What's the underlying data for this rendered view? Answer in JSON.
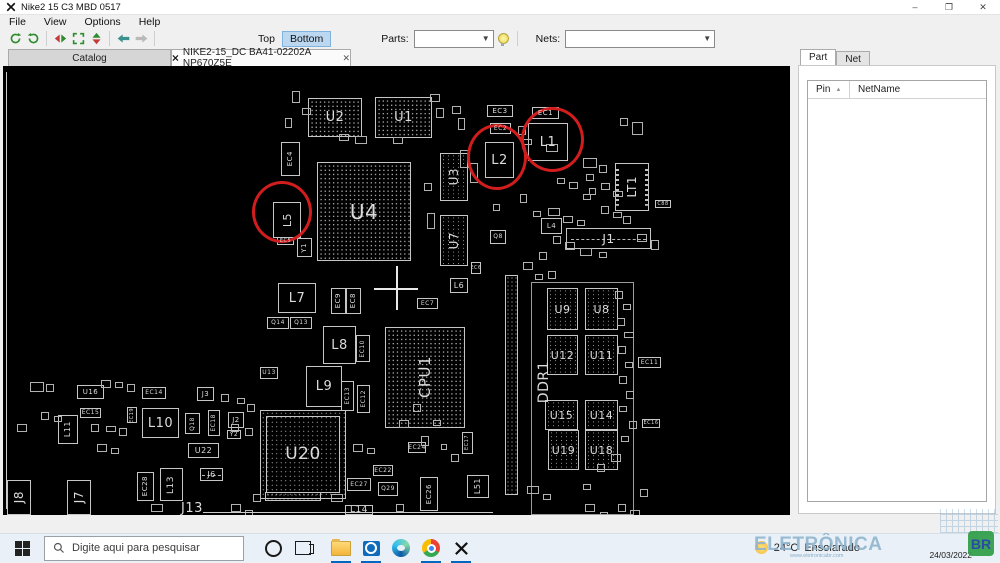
{
  "window": {
    "title": "Nike2 15 C3 MBD 0517",
    "controls": {
      "minimize": "–",
      "maximize": "❐",
      "close": "✕"
    }
  },
  "menu": {
    "items": [
      "File",
      "View",
      "Options",
      "Help"
    ]
  },
  "toolbar": {
    "top_label": "Top",
    "bottom_label": "Bottom",
    "parts_label": "Parts:",
    "parts_value": "",
    "nets_label": "Nets:",
    "nets_value": ""
  },
  "tabs": [
    {
      "label": "Catalog",
      "active": false
    },
    {
      "label": "NIKE2-15_DC BA41-02202A NP670Z5E",
      "active": true,
      "close_glyph": "✕"
    }
  ],
  "side_panel": {
    "tabs": [
      {
        "label": "Part",
        "active": true
      },
      {
        "label": "Net",
        "active": false
      }
    ],
    "table": {
      "columns": [
        "Pin",
        "NetName"
      ],
      "sort_indicator": "▲",
      "rows": []
    }
  },
  "board": {
    "components": [
      {
        "l": "U2",
        "x": 305,
        "y": 32,
        "w": 54,
        "h": 39,
        "t": "bga",
        "fs": 13
      },
      {
        "l": "U1",
        "x": 372,
        "y": 31,
        "w": 57,
        "h": 41,
        "t": "bga",
        "fs": 13
      },
      {
        "l": "EC3",
        "x": 484,
        "y": 39,
        "w": 26,
        "h": 12,
        "fs": 7
      },
      {
        "l": "EC1",
        "x": 529,
        "y": 41,
        "w": 27,
        "h": 12,
        "fs": 7
      },
      {
        "l": "EC2",
        "x": 487,
        "y": 57,
        "w": 21,
        "h": 11,
        "fs": 6
      },
      {
        "l": "L2",
        "x": 482,
        "y": 76,
        "w": 29,
        "h": 36,
        "fs": 13
      },
      {
        "l": "L1",
        "x": 525,
        "y": 57,
        "w": 40,
        "h": 38,
        "fs": 13
      },
      {
        "l": "U3",
        "x": 437,
        "y": 87,
        "w": 28,
        "h": 48,
        "t": "mem",
        "v": 1,
        "fs": 12
      },
      {
        "l": "EC4",
        "x": 278,
        "y": 76,
        "w": 19,
        "h": 34,
        "v": 1,
        "fs": 7
      },
      {
        "l": "L5",
        "x": 270,
        "y": 136,
        "w": 28,
        "h": 36,
        "v": 1,
        "fs": 11
      },
      {
        "l": "EC5",
        "x": 274,
        "y": 171,
        "w": 17,
        "h": 8,
        "fs": 5
      },
      {
        "l": "Y1",
        "x": 294,
        "y": 172,
        "w": 15,
        "h": 19,
        "v": 1,
        "fs": 7
      },
      {
        "l": "U4",
        "x": 314,
        "y": 96,
        "w": 94,
        "h": 99,
        "t": "bga",
        "fs": 20
      },
      {
        "l": "U7",
        "x": 437,
        "y": 149,
        "w": 28,
        "h": 51,
        "t": "mem",
        "v": 1,
        "fs": 12
      },
      {
        "l": "EC6",
        "x": 468,
        "y": 196,
        "w": 10,
        "h": 12,
        "fs": 5
      },
      {
        "l": "L7",
        "x": 275,
        "y": 217,
        "w": 38,
        "h": 30,
        "fs": 13
      },
      {
        "l": "Q14",
        "x": 264,
        "y": 251,
        "w": 22,
        "h": 12,
        "fs": 6
      },
      {
        "l": "Q13",
        "x": 287,
        "y": 251,
        "w": 22,
        "h": 12,
        "fs": 6
      },
      {
        "l": "EC9",
        "x": 328,
        "y": 222,
        "w": 15,
        "h": 26,
        "v": 1,
        "fs": 7
      },
      {
        "l": "EC8",
        "x": 343,
        "y": 222,
        "w": 15,
        "h": 26,
        "v": 1,
        "fs": 7
      },
      {
        "l": "L8",
        "x": 320,
        "y": 260,
        "w": 33,
        "h": 38,
        "fs": 13
      },
      {
        "l": "EC10",
        "x": 353,
        "y": 269,
        "w": 14,
        "h": 27,
        "v": 1,
        "fs": 6
      },
      {
        "l": "L9",
        "x": 303,
        "y": 300,
        "w": 36,
        "h": 41,
        "fs": 13
      },
      {
        "l": "EC13",
        "x": 338,
        "y": 315,
        "w": 13,
        "h": 30,
        "v": 1,
        "fs": 6
      },
      {
        "l": "EC12",
        "x": 354,
        "y": 319,
        "w": 13,
        "h": 28,
        "v": 1,
        "fs": 6
      },
      {
        "l": "U13",
        "x": 257,
        "y": 301,
        "w": 18,
        "h": 12,
        "fs": 6
      },
      {
        "l": "CPU1",
        "x": 382,
        "y": 261,
        "w": 80,
        "h": 101,
        "t": "bga",
        "v": 1,
        "fs": 15
      },
      {
        "l": "L6",
        "x": 447,
        "y": 212,
        "w": 18,
        "h": 15,
        "fs": 8
      },
      {
        "l": "EC7",
        "x": 414,
        "y": 232,
        "w": 21,
        "h": 11,
        "fs": 6
      },
      {
        "l": "Q8",
        "x": 487,
        "y": 164,
        "w": 16,
        "h": 14,
        "fs": 6
      },
      {
        "l": "L4",
        "x": 538,
        "y": 152,
        "w": 21,
        "h": 16,
        "fs": 7
      },
      {
        "l": "J1",
        "x": 563,
        "y": 162,
        "w": 85,
        "h": 21,
        "t": "conn",
        "fs": 12
      },
      {
        "l": "LT1",
        "x": 612,
        "y": 97,
        "w": 34,
        "h": 48,
        "t": "conn2",
        "v": 1,
        "fs": 12
      },
      {
        "l": "C88",
        "x": 652,
        "y": 134,
        "w": 16,
        "h": 8,
        "fs": 5
      },
      {
        "l": "DDR1",
        "x": 534,
        "y": 284,
        "w": 14,
        "h": 64,
        "t": "noborder",
        "v": 1,
        "fs": 14
      },
      {
        "l": "U9",
        "x": 544,
        "y": 222,
        "w": 31,
        "h": 42,
        "t": "mem",
        "fs": 11
      },
      {
        "l": "U8",
        "x": 582,
        "y": 222,
        "w": 33,
        "h": 42,
        "t": "mem",
        "fs": 11
      },
      {
        "l": "U12",
        "x": 544,
        "y": 269,
        "w": 31,
        "h": 40,
        "t": "mem",
        "fs": 11
      },
      {
        "l": "U11",
        "x": 582,
        "y": 269,
        "w": 33,
        "h": 40,
        "t": "mem",
        "fs": 11
      },
      {
        "l": "U15",
        "x": 542,
        "y": 334,
        "w": 33,
        "h": 30,
        "t": "mem",
        "fs": 11
      },
      {
        "l": "U14",
        "x": 582,
        "y": 334,
        "w": 33,
        "h": 30,
        "t": "mem",
        "fs": 11
      },
      {
        "l": "U19",
        "x": 545,
        "y": 364,
        "w": 31,
        "h": 40,
        "t": "mem",
        "fs": 11
      },
      {
        "l": "U18",
        "x": 582,
        "y": 364,
        "w": 33,
        "h": 40,
        "t": "mem",
        "fs": 11
      },
      {
        "l": "EC11",
        "x": 635,
        "y": 291,
        "w": 23,
        "h": 11,
        "fs": 6
      },
      {
        "l": "EC16",
        "x": 639,
        "y": 353,
        "w": 18,
        "h": 9,
        "fs": 5
      },
      {
        "l": "U16",
        "x": 74,
        "y": 319,
        "w": 27,
        "h": 14,
        "fs": 7
      },
      {
        "l": "EC14",
        "x": 139,
        "y": 321,
        "w": 24,
        "h": 12,
        "fs": 6
      },
      {
        "l": "J3",
        "x": 194,
        "y": 321,
        "w": 17,
        "h": 14,
        "fs": 7
      },
      {
        "l": "EC15",
        "x": 77,
        "y": 342,
        "w": 21,
        "h": 10,
        "fs": 6
      },
      {
        "l": "L11",
        "x": 55,
        "y": 349,
        "w": 20,
        "h": 29,
        "v": 1,
        "fs": 8
      },
      {
        "l": "L10",
        "x": 139,
        "y": 342,
        "w": 37,
        "h": 30,
        "fs": 13
      },
      {
        "l": "Q18",
        "x": 182,
        "y": 347,
        "w": 15,
        "h": 21,
        "v": 1,
        "fs": 6
      },
      {
        "l": "EC18",
        "x": 205,
        "y": 344,
        "w": 12,
        "h": 26,
        "v": 1,
        "fs": 6
      },
      {
        "l": "J2",
        "x": 225,
        "y": 346,
        "w": 16,
        "h": 16,
        "fs": 7
      },
      {
        "l": "Y2",
        "x": 224,
        "y": 364,
        "w": 14,
        "h": 9,
        "fs": 6
      },
      {
        "l": "U22",
        "x": 185,
        "y": 377,
        "w": 31,
        "h": 15,
        "fs": 8
      },
      {
        "l": "J6",
        "x": 197,
        "y": 402,
        "w": 23,
        "h": 13,
        "t": "conn",
        "fs": 8
      },
      {
        "l": "EC28",
        "x": 134,
        "y": 406,
        "w": 17,
        "h": 29,
        "v": 1,
        "fs": 7
      },
      {
        "l": "L13",
        "x": 157,
        "y": 402,
        "w": 23,
        "h": 33,
        "v": 1,
        "fs": 9
      },
      {
        "l": "J13",
        "x": 172,
        "y": 436,
        "w": 34,
        "h": 13,
        "t": "noborder",
        "fs": 13
      },
      {
        "l": "J8",
        "x": 4,
        "y": 414,
        "w": 24,
        "h": 35,
        "v": 1,
        "fs": 12
      },
      {
        "l": "J7",
        "x": 64,
        "y": 414,
        "w": 24,
        "h": 35,
        "v": 1,
        "fs": 12
      },
      {
        "l": "U20",
        "x": 257,
        "y": 344,
        "w": 86,
        "h": 89,
        "t": "qfp",
        "fs": 17
      },
      {
        "l": "EC24",
        "x": 405,
        "y": 376,
        "w": 18,
        "h": 11,
        "fs": 6
      },
      {
        "l": "EC22",
        "x": 370,
        "y": 399,
        "w": 20,
        "h": 11,
        "fs": 6
      },
      {
        "l": "EC27",
        "x": 344,
        "y": 412,
        "w": 24,
        "h": 13,
        "fs": 6
      },
      {
        "l": "Q29",
        "x": 375,
        "y": 416,
        "w": 20,
        "h": 14,
        "fs": 6
      },
      {
        "l": "EC26",
        "x": 417,
        "y": 411,
        "w": 18,
        "h": 34,
        "v": 1,
        "fs": 7
      },
      {
        "l": "L51",
        "x": 464,
        "y": 409,
        "w": 22,
        "h": 23,
        "v": 1,
        "fs": 8
      },
      {
        "l": "L14",
        "x": 342,
        "y": 439,
        "w": 28,
        "h": 10,
        "fs": 9
      },
      {
        "l": "EC17",
        "x": 459,
        "y": 366,
        "w": 11,
        "h": 22,
        "v": 1,
        "fs": 5
      },
      {
        "l": "EC19",
        "x": 124,
        "y": 341,
        "w": 10,
        "h": 16,
        "v": 1,
        "fs": 5
      },
      {
        "t": "outline",
        "x": 528,
        "y": 216,
        "w": 103,
        "h": 233
      },
      {
        "t": "dotcol",
        "x": 502,
        "y": 209,
        "w": 13,
        "h": 220
      },
      {
        "t": "dotrow",
        "x": 262,
        "y": 426,
        "w": 56,
        "h": 9
      }
    ],
    "small_parts": [
      [
        289,
        25,
        8,
        12
      ],
      [
        299,
        42,
        9,
        7
      ],
      [
        282,
        52,
        7,
        10
      ],
      [
        336,
        68,
        10,
        7
      ],
      [
        352,
        70,
        12,
        8
      ],
      [
        390,
        71,
        10,
        7
      ],
      [
        427,
        28,
        10,
        8
      ],
      [
        433,
        42,
        8,
        10
      ],
      [
        449,
        40,
        9,
        8
      ],
      [
        455,
        52,
        7,
        12
      ],
      [
        457,
        84,
        9,
        18
      ],
      [
        467,
        97,
        8,
        20
      ],
      [
        515,
        60,
        8,
        9
      ],
      [
        519,
        73,
        10,
        6
      ],
      [
        543,
        78,
        12,
        8
      ],
      [
        580,
        92,
        14,
        10
      ],
      [
        583,
        108,
        8,
        7
      ],
      [
        596,
        99,
        8,
        8
      ],
      [
        617,
        52,
        8,
        8
      ],
      [
        629,
        56,
        11,
        13
      ],
      [
        598,
        117,
        9,
        7
      ],
      [
        610,
        125,
        10,
        6
      ],
      [
        580,
        128,
        8,
        6
      ],
      [
        530,
        145,
        8,
        6
      ],
      [
        545,
        142,
        12,
        8
      ],
      [
        421,
        117,
        8,
        8
      ],
      [
        424,
        147,
        8,
        16
      ],
      [
        490,
        138,
        7,
        7
      ],
      [
        517,
        128,
        7,
        9
      ],
      [
        554,
        112,
        8,
        6
      ],
      [
        566,
        116,
        9,
        7
      ],
      [
        586,
        122,
        7,
        7
      ],
      [
        598,
        140,
        8,
        8
      ],
      [
        610,
        146,
        9,
        6
      ],
      [
        620,
        150,
        8,
        8
      ],
      [
        634,
        168,
        10,
        8
      ],
      [
        648,
        174,
        8,
        10
      ],
      [
        560,
        150,
        10,
        7
      ],
      [
        574,
        154,
        8,
        6
      ],
      [
        550,
        170,
        8,
        8
      ],
      [
        562,
        176,
        10,
        8
      ],
      [
        577,
        182,
        12,
        8
      ],
      [
        536,
        186,
        8,
        8
      ],
      [
        596,
        186,
        8,
        6
      ],
      [
        520,
        196,
        10,
        8
      ],
      [
        532,
        208,
        8,
        6
      ],
      [
        545,
        205,
        8,
        8
      ],
      [
        612,
        225,
        8,
        8
      ],
      [
        620,
        238,
        8,
        6
      ],
      [
        614,
        252,
        8,
        8
      ],
      [
        621,
        266,
        10,
        6
      ],
      [
        615,
        280,
        8,
        8
      ],
      [
        622,
        296,
        8,
        6
      ],
      [
        616,
        310,
        8,
        8
      ],
      [
        623,
        325,
        8,
        8
      ],
      [
        616,
        340,
        8,
        6
      ],
      [
        626,
        355,
        8,
        8
      ],
      [
        618,
        370,
        8,
        6
      ],
      [
        608,
        388,
        10,
        8
      ],
      [
        594,
        398,
        8,
        8
      ],
      [
        27,
        316,
        14,
        10
      ],
      [
        43,
        318,
        8,
        8
      ],
      [
        98,
        314,
        10,
        8
      ],
      [
        112,
        316,
        8,
        6
      ],
      [
        124,
        318,
        8,
        8
      ],
      [
        38,
        346,
        8,
        8
      ],
      [
        51,
        350,
        8,
        6
      ],
      [
        88,
        358,
        8,
        8
      ],
      [
        103,
        360,
        10,
        6
      ],
      [
        116,
        362,
        8,
        8
      ],
      [
        218,
        328,
        8,
        8
      ],
      [
        234,
        332,
        8,
        6
      ],
      [
        244,
        338,
        8,
        8
      ],
      [
        14,
        358,
        10,
        8
      ],
      [
        228,
        358,
        8,
        8
      ],
      [
        242,
        362,
        8,
        8
      ],
      [
        94,
        378,
        10,
        8
      ],
      [
        108,
        382,
        8,
        6
      ],
      [
        148,
        438,
        12,
        8
      ],
      [
        228,
        438,
        10,
        8
      ],
      [
        242,
        444,
        8,
        6
      ],
      [
        250,
        428,
        8,
        8
      ],
      [
        350,
        378,
        10,
        8
      ],
      [
        364,
        382,
        8,
        6
      ],
      [
        328,
        428,
        12,
        8
      ],
      [
        393,
        438,
        8,
        8
      ],
      [
        418,
        370,
        8,
        10
      ],
      [
        438,
        378,
        6,
        6
      ],
      [
        448,
        388,
        8,
        8
      ],
      [
        430,
        354,
        8,
        6
      ],
      [
        396,
        354,
        10,
        8
      ],
      [
        410,
        338,
        8,
        8
      ],
      [
        582,
        438,
        10,
        8
      ],
      [
        597,
        446,
        8,
        6
      ],
      [
        615,
        438,
        8,
        8
      ],
      [
        627,
        444,
        10,
        8
      ],
      [
        580,
        418,
        8,
        6
      ],
      [
        637,
        423,
        8,
        8
      ],
      [
        524,
        420,
        12,
        8
      ],
      [
        540,
        428,
        8,
        6
      ]
    ],
    "highlights": [
      {
        "x": 249,
        "y": 115,
        "w": 60,
        "h": 62
      },
      {
        "x": 464,
        "y": 58,
        "w": 60,
        "h": 66
      },
      {
        "x": 518,
        "y": 41,
        "w": 63,
        "h": 65
      }
    ],
    "lines": [
      {
        "x": 3,
        "y": 6,
        "w": 1,
        "h": 437
      },
      {
        "x": 200,
        "y": 446,
        "w": 290,
        "h": 1
      }
    ],
    "crosshair": {
      "x": 393,
      "y": 222,
      "arm": 22
    }
  },
  "taskbar": {
    "search_placeholder": "Digite aqui para pesquisar",
    "weather": {
      "temp": "24°C",
      "condition": "Ensolarado"
    },
    "date": "24/03/2022"
  },
  "watermark": {
    "text": "ELETRÔNICA",
    "suffix": "BR",
    "url": "www.eletronicabr.com"
  }
}
